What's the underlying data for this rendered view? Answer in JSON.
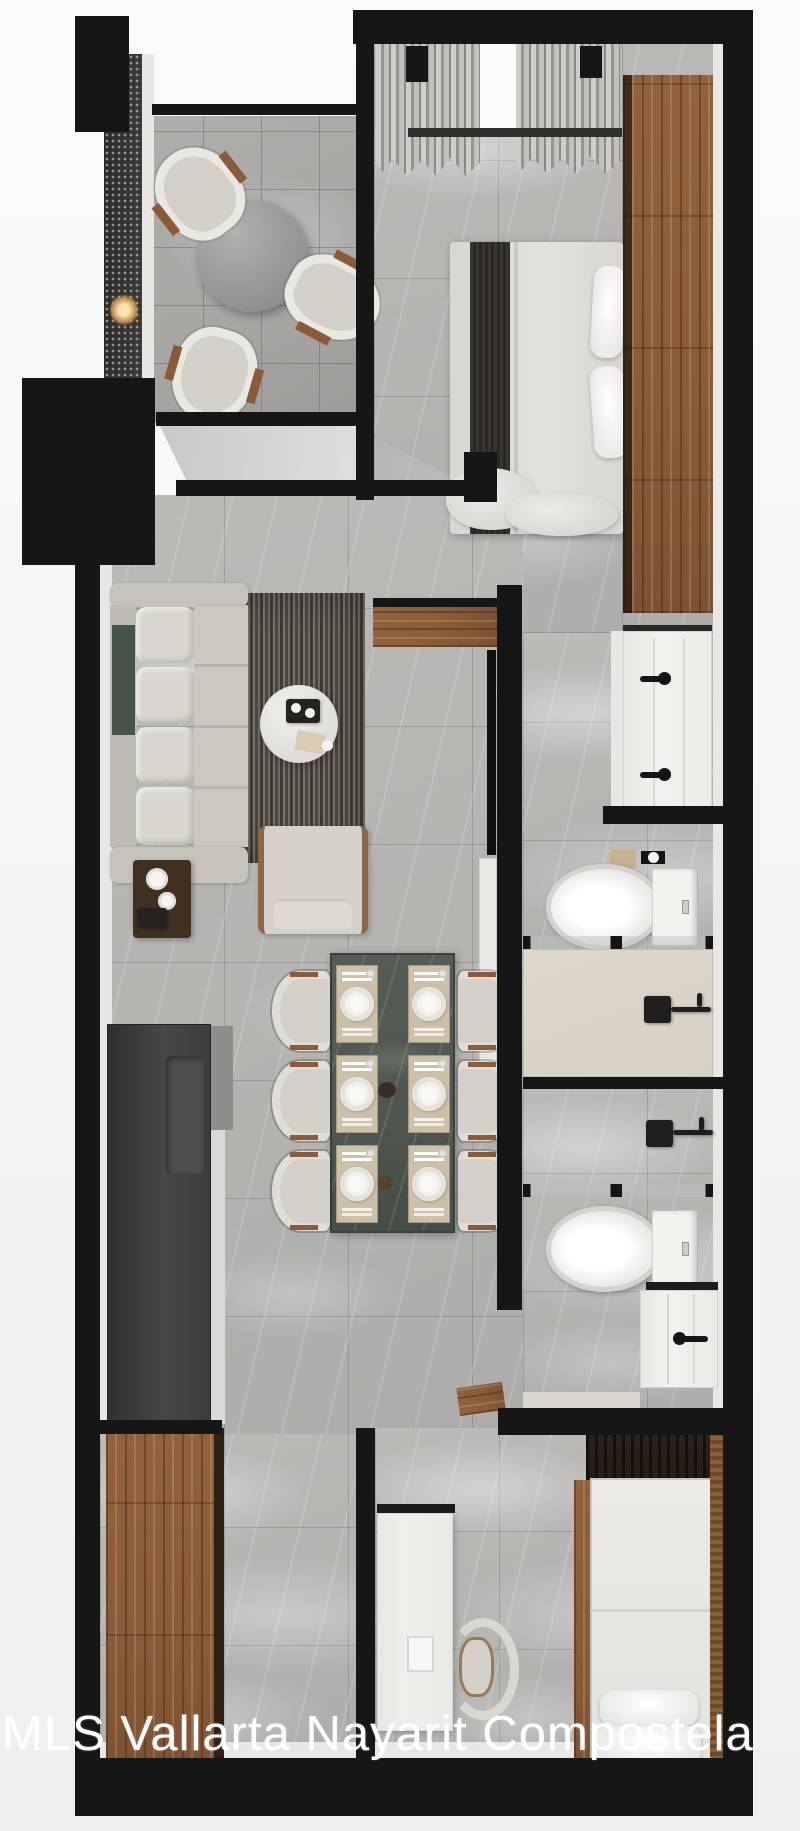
{
  "watermark": {
    "text": "MLS Vallarta Nayarit Compostela",
    "color": "#ffffff"
  },
  "palette": {
    "wall": "#161616",
    "floor": "#b5b3b0",
    "balcony_floor": "#a8a6a3",
    "wood": "#8a5b38",
    "wood_dark": "#5f4127",
    "wardrobe_dark": "#241d17",
    "upholstery": "#d3d0c9",
    "cushion_green": "#46544b",
    "rug_dark": "#4b473f",
    "rug_light": "#716c62",
    "stone_table": "#50564f",
    "counter_dark": "#3c3c3c",
    "fixture_white": "#f3f1ee",
    "shower_floor": "#d7d1c5",
    "placemat": "#cdc0a9",
    "curtain_light": "#cfcdc9",
    "curtain_dark": "#96948f",
    "watermark": "#ffffff"
  },
  "objects": [
    "balcony-round-table",
    "outdoor-chair",
    "wall-lamp",
    "privacy-screen",
    "glass-sliding-door",
    "double-bed",
    "window-curtains",
    "master-wardrobe",
    "sofa",
    "area-rug",
    "coffee-table",
    "armchair",
    "side-table",
    "tv-console",
    "wall-tv",
    "kitchen-counter",
    "dining-table",
    "dining-chair",
    "place-setting",
    "bathroom-vanity",
    "toilet",
    "shower",
    "shower-glass",
    "desk",
    "desk-chair",
    "single-bed",
    "slat-accent-wall",
    "closet-wardrobe"
  ]
}
